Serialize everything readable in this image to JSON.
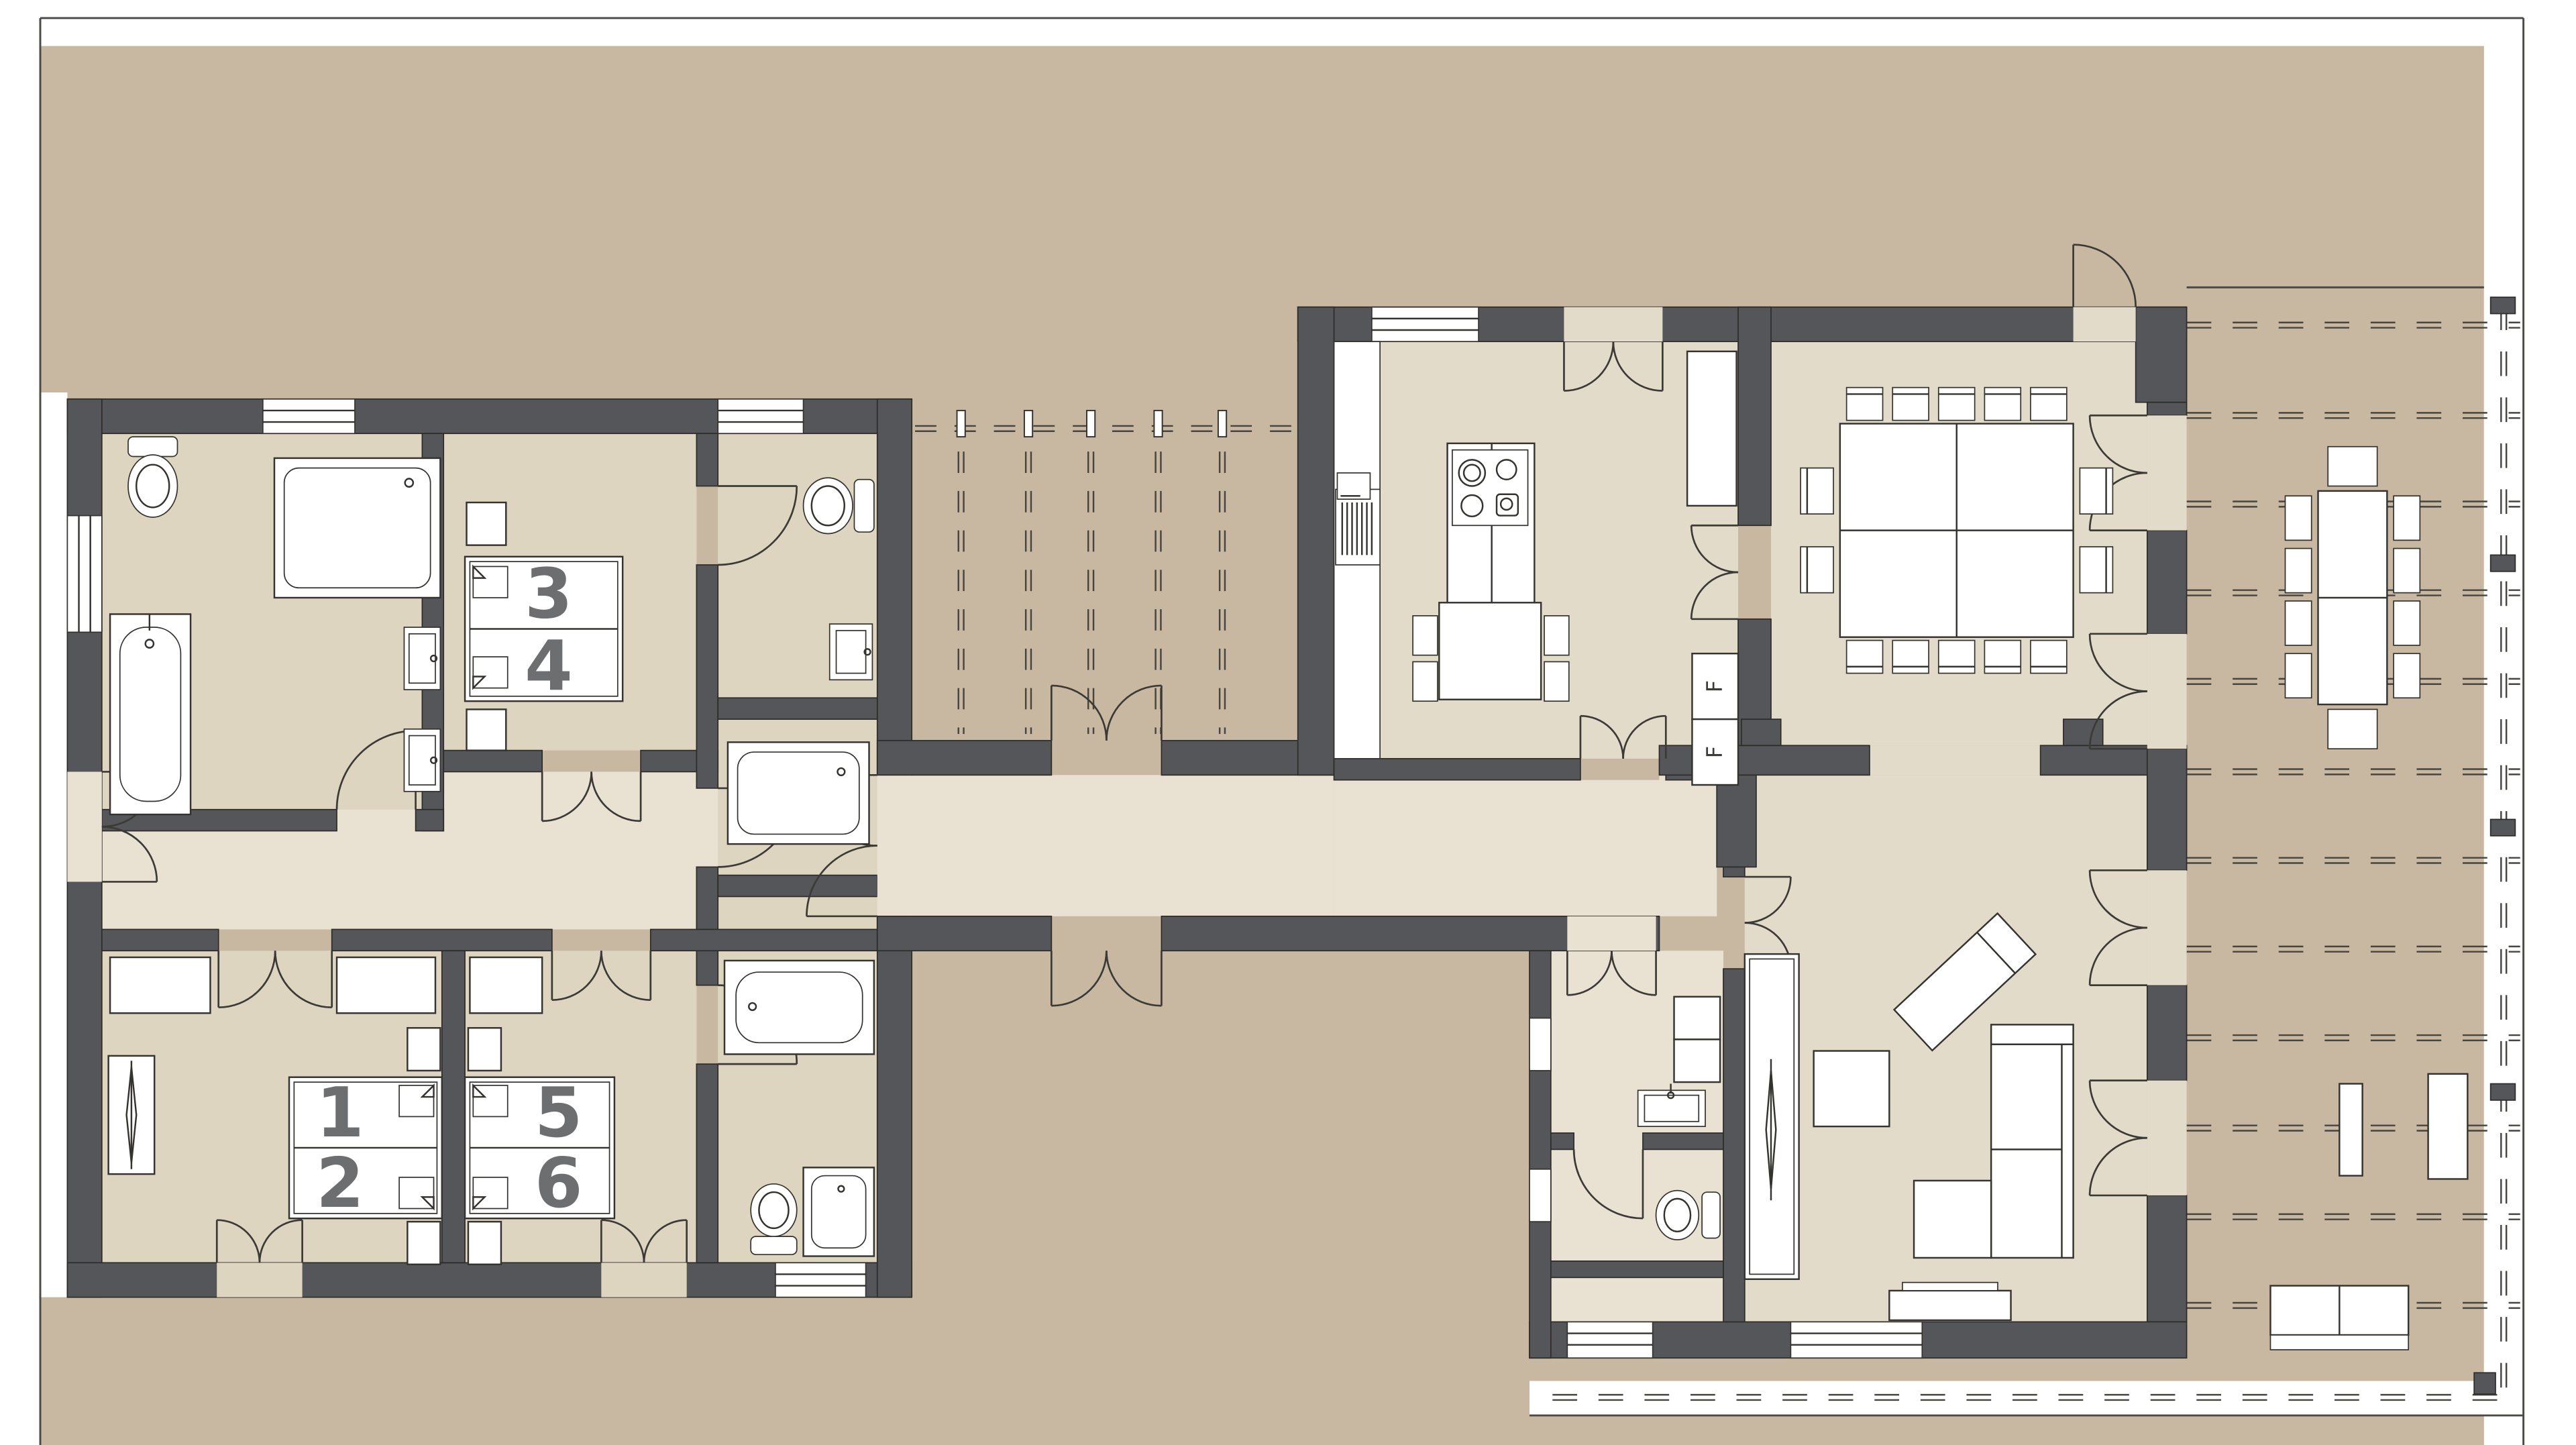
{
  "plan": {
    "kind": "architectural-floor-plan",
    "view": "ground-floor"
  },
  "beds": [
    {
      "label": "1"
    },
    {
      "label": "2"
    },
    {
      "label": "3"
    },
    {
      "label": "4"
    },
    {
      "label": "5"
    },
    {
      "label": "6"
    }
  ],
  "kitchen": {
    "fridge_labels": [
      "F",
      "F"
    ]
  },
  "colors": {
    "site": "#c8b8a1",
    "hall_floor": "#e9e2d2",
    "room_floor": "#ded5c1",
    "living_floor": "#e3dbc9",
    "wall": "#55565a",
    "outline": "#2e2c29",
    "fixture": "#ffffff",
    "bed_label": "#6d6e70"
  }
}
